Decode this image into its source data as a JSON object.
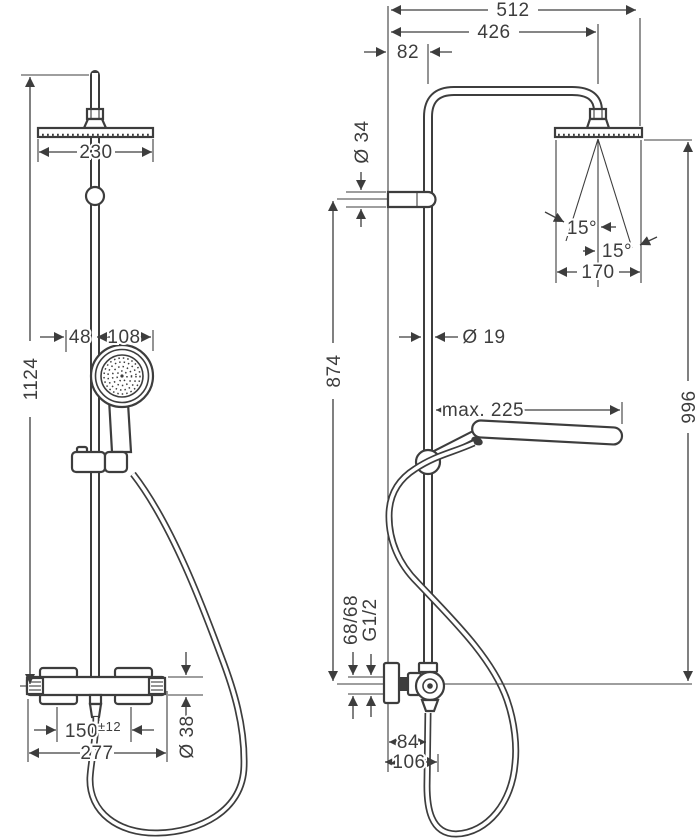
{
  "front_view": {
    "head_width": "230",
    "overall_height": "1124",
    "handshower_offset": "48",
    "handshower_width": "108",
    "connection_spacing": "150",
    "connection_tolerance": "±12",
    "valve_width": "277",
    "valve_diameter": "Ø 38"
  },
  "side_view": {
    "overall_reach": "512",
    "arm_reach": "426",
    "top_wall_offset": "82",
    "bracket_diameter": "Ø 34",
    "spray_angle_left": "15°",
    "spray_angle_right": "15°",
    "head_depth": "170",
    "pipe_diameter": "Ø 19",
    "riser_height": "874",
    "handshower_reach": "max. 225",
    "head_height": "996",
    "connection_offset": "68/68",
    "thread_size": "G1/2",
    "wall_to_pipe": "84",
    "wall_to_hose": "106"
  },
  "line_color": "#3d3d3d"
}
